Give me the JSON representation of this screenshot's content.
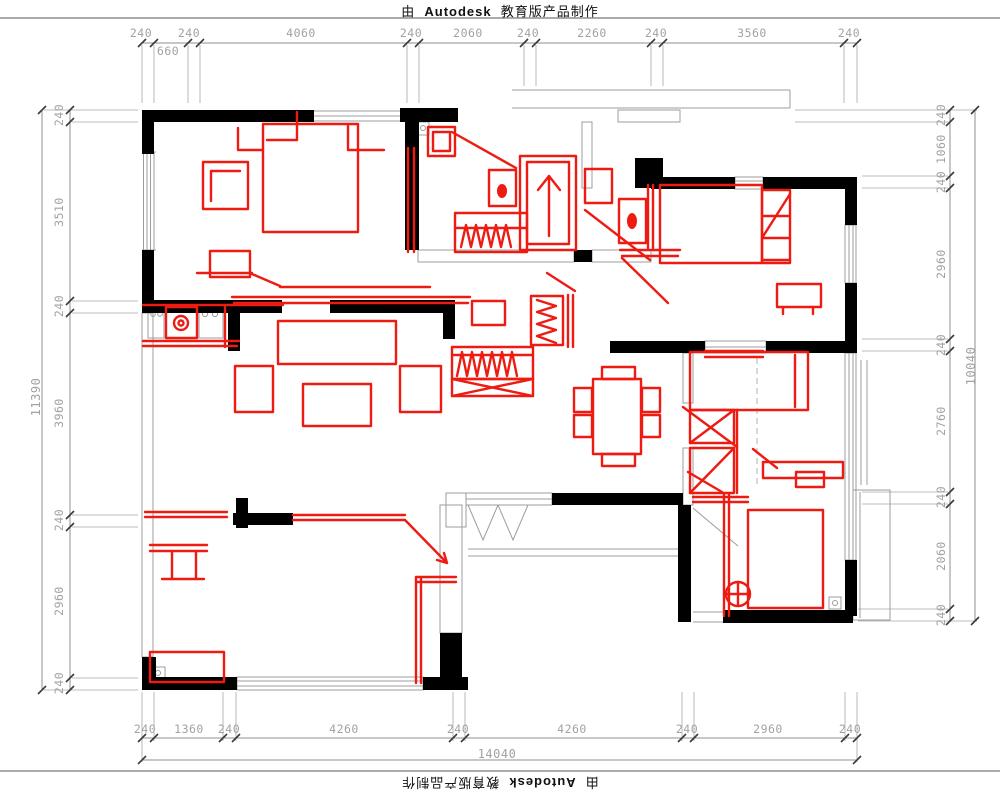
{
  "banner": {
    "prefix": "由",
    "brand": "Autodesk",
    "suffix": "教育版产品制作"
  },
  "dimensions": {
    "top": {
      "labels": [
        "240",
        "240",
        "4060",
        "240",
        "2060",
        "240",
        "2260",
        "240",
        "3560",
        "240"
      ],
      "sub_label": "660"
    },
    "bottom": {
      "labels": [
        "240",
        "1360",
        "240",
        "4260",
        "240",
        "4260",
        "240",
        "2960",
        "240"
      ],
      "total": "14040"
    },
    "left": {
      "labels": [
        "240",
        "3510",
        "240",
        "3960",
        "240",
        "2960",
        "240"
      ],
      "total": "11390"
    },
    "right": {
      "labels": [
        "240",
        "1060",
        "240",
        "2960",
        "240",
        "2760",
        "240",
        "2060",
        "240"
      ],
      "total": "10040"
    }
  },
  "colors": {
    "walls": "#000000",
    "furniture_red": "#ee1b12",
    "dimension_text": "#a2a2a2",
    "dimension_lines": "#8f8f8f",
    "thin_lines": "#9c9c9c",
    "background": "#ffffff"
  }
}
